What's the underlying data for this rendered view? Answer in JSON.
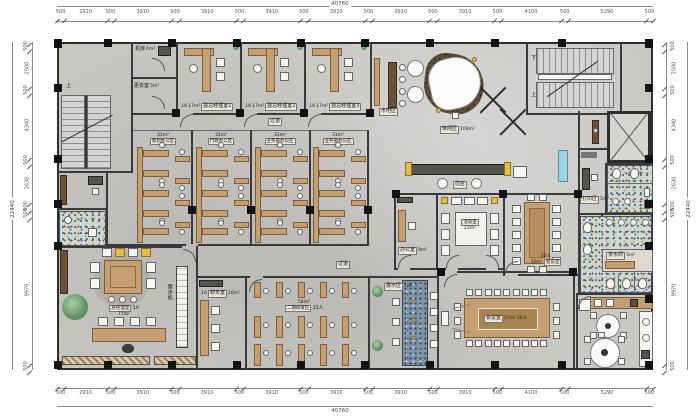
{
  "dimensions": {
    "total_width": "40760",
    "total_height": "22440",
    "top": [
      "500",
      "2910",
      "500",
      "3910",
      "500",
      "3910",
      "500",
      "3910",
      "500",
      "3910",
      "500",
      "3910",
      "500",
      "3910",
      "500",
      "4100",
      "500",
      "5290",
      "500"
    ],
    "bottom": [
      "500",
      "2910",
      "500",
      "3910",
      "500",
      "3910",
      "500",
      "3910",
      "500",
      "3910",
      "500",
      "3910",
      "500",
      "3910",
      "500",
      "4100",
      "500",
      "5290",
      "500"
    ],
    "left": [
      "500",
      "2500",
      "500",
      "4340",
      "500",
      "2630",
      "500",
      "500",
      "9970",
      "500"
    ],
    "right": [
      "500",
      "2500",
      "500",
      "4340",
      "500",
      "2630",
      "500",
      "500",
      "9970",
      "500"
    ]
  },
  "stairs": {
    "tl_up": "上",
    "tr_up": "上",
    "tr_down": "下"
  },
  "rooms": {
    "machine_room": {
      "label": "机房",
      "area": "4m²"
    },
    "locker_room": {
      "label": "更衣室",
      "area": "5m²"
    },
    "vgm_offices": [
      {
        "area": "1A.17m²",
        "label": "副总经理室1"
      },
      {
        "area": "1A.17m²",
        "label": "副总经理室2"
      },
      {
        "area": "1A.17m²",
        "label": "副总经理室3"
      }
    ],
    "water_bar": {
      "label": "水吧区"
    },
    "lounge": {
      "label": "休闲区",
      "area": "108m²"
    },
    "corridor_top": {
      "label": "过道"
    },
    "corridor_bottom": {
      "label": "过道"
    },
    "office_bays": [
      {
        "area": "31m²",
        "label": "策划办公区",
        "seats": "8人"
      },
      {
        "area": "31m²",
        "label": "行政办公区",
        "seats": "8人"
      },
      {
        "area": "31m²",
        "label": "业务部办公区",
        "seats": "8人"
      },
      {
        "area": "31m²",
        "label": "业务部办公区",
        "seats": "8人"
      }
    ],
    "reception": {
      "label": "前台"
    },
    "small_office": {
      "label": "办公室",
      "area": "9m²"
    },
    "negotiation": {
      "label": "洽谈室",
      "area": "23m²"
    },
    "meeting_12": {
      "label": "会议室",
      "area": "32m²",
      "seats": "12人"
    },
    "gm_office": {
      "label": "总经理室",
      "tag": "1A",
      "area": "77m²"
    },
    "treadmill": {
      "label": "跑步机"
    },
    "finance": {
      "label": "财务室",
      "tag": "1A",
      "area": "20m²"
    },
    "rd_area": {
      "label": "二期研发区",
      "seats": "15人",
      "area": "54m²"
    },
    "gallery": {
      "label": "展示区",
      "area": "7m²"
    },
    "conference_26": {
      "label": "会议室",
      "area": "57m²",
      "seats": "26人"
    },
    "pantry": {
      "label": "茶水间",
      "area": "5m²"
    },
    "print_nook": {
      "label": "打印区",
      "area": "5m²"
    }
  },
  "colors": {
    "wall": "#3a3a3a",
    "floor": "#c9c8c5",
    "wood": "#c59e72",
    "accent_yellow": "#e3bc4a",
    "plant_green": "#5d8f5e",
    "mosaic_blue": "#2e6f7e"
  }
}
